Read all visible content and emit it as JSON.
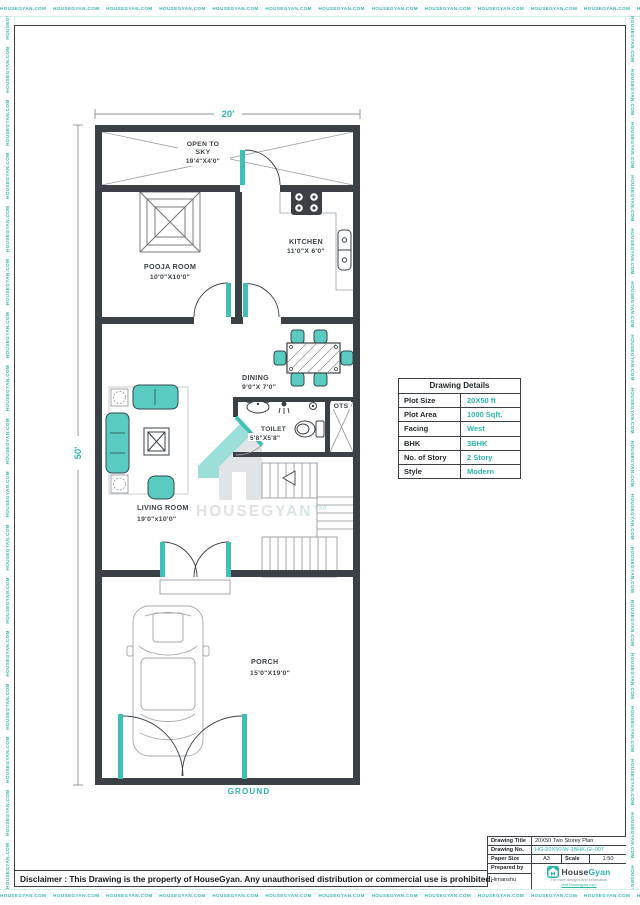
{
  "border": {
    "watermark_text": "HOUSEGYAN.COM"
  },
  "dimensions": {
    "width": "20'",
    "depth": "50'"
  },
  "plan": {
    "ground_label": "GROUND",
    "rooms": {
      "open_to_sky": {
        "name_line1": "OPEN TO",
        "name_line2": "SKY",
        "size": "19'4\"X4'0\""
      },
      "pooja": {
        "name": "POOJA ROOM",
        "size": "10'0\"X10'0\""
      },
      "kitchen": {
        "name": "KITCHEN",
        "size": "11'0\"X 6'0\""
      },
      "dining": {
        "name": "DINING",
        "size": "9'0\"X 7'0\""
      },
      "toilet": {
        "name": "TOILET",
        "size": "5'8\"X5'8\""
      },
      "ots": {
        "name": "OTS"
      },
      "living": {
        "name": "LIVING ROOM",
        "size": "19'0\"x10'0\""
      },
      "porch": {
        "name": "PORCH",
        "size": "15'0\"X19'0\""
      }
    }
  },
  "watermark": {
    "brand": "HOUSEGYAN™"
  },
  "details_table": {
    "title": "Drawing Details",
    "rows": [
      {
        "label": "Plot Size",
        "value": "20X50 ft"
      },
      {
        "label": "Plot Area",
        "value": "1000 Sqft."
      },
      {
        "label": "Facing",
        "value": "West"
      },
      {
        "label": "BHK",
        "value": "3BHK"
      },
      {
        "label": "No. of Story",
        "value": "2 Story"
      },
      {
        "label": "Style",
        "value": "Modern"
      }
    ]
  },
  "title_block": {
    "drawing_title_label": "Drawing Title",
    "drawing_title": "20X50 Two Storey Plan",
    "drawing_no_label": "Drawing No.",
    "drawing_no": "HG-20X50-W-3BHK-GI-007",
    "paper_size_label": "Paper Size",
    "paper_size": "A3",
    "scale_label": "Scale",
    "scale": "1:50",
    "prepared_by_label": "Prepared by",
    "prepared_by": "Himanshu",
    "brand": {
      "name_part1": "House",
      "name_part2": "Gyan",
      "tagline_line1": "For more designs and information",
      "tagline_line2": "visit Housegyan.com"
    }
  },
  "disclaimer": "Disclaimer : This Drawing is the property of HouseGyan. Any unauthorised distribution or commercial use is prohibited.",
  "colors": {
    "accent_teal": "#2BB5AC",
    "wall_dark": "#3A4045"
  }
}
